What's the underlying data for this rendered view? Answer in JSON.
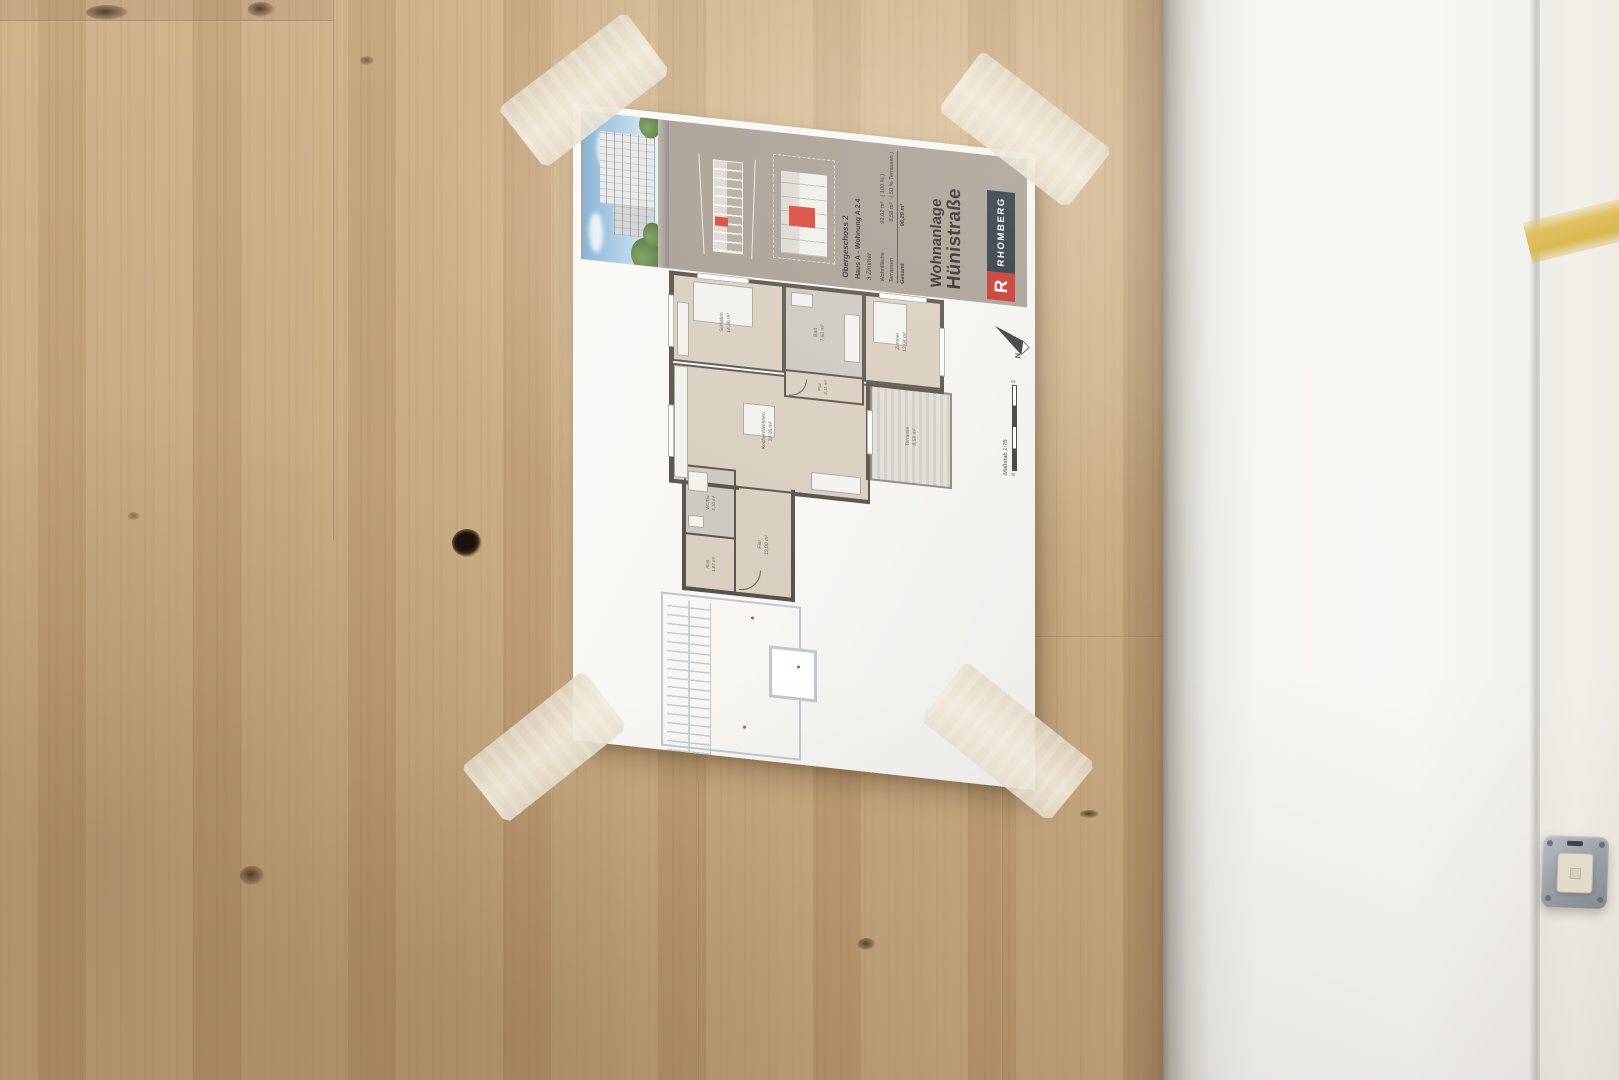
{
  "sheet": {
    "title": {
      "line1": "Wohnanlage",
      "line2": "Hünistraße"
    },
    "brand": {
      "name": "RHOMBERG",
      "initial": "R"
    },
    "unit_info": {
      "floor": "Obergeschoss 2",
      "unit": "Haus A - Wohnung A.2.4",
      "room_count": "3 Zimmer"
    },
    "area_table": {
      "rows": [
        {
          "label": "Wohnfläche",
          "value": "92,02 m²",
          "note": "( 100 % )"
        },
        {
          "label": "Terrassen",
          "value": "8,58 m²",
          "note": "( 50 % Terrassen )"
        },
        {
          "label": "Gesamt",
          "value": "96,29 m²",
          "note": ""
        }
      ]
    },
    "scale": {
      "label": "Maßstab 1:75",
      "zero": "0",
      "five": "5",
      "north": "N"
    },
    "rooms": [
      {
        "name": "Schlafen",
        "area": "14,36 m²"
      },
      {
        "name": "Bad",
        "area": "7,60 m²"
      },
      {
        "name": "Zimmer",
        "area": "12,04 m²"
      },
      {
        "name": "Flur",
        "area": "4,11 m²"
      },
      {
        "name": "Kochen/Wohnen",
        "area": "33,05 m²"
      },
      {
        "name": "Terrasse",
        "area": "8,58 m²"
      },
      {
        "name": "WC/Du",
        "area": "4,10 m²"
      },
      {
        "name": "Abst.",
        "area": "1,87 m²"
      },
      {
        "name": "Flur",
        "area": "13,00 m²"
      }
    ]
  },
  "colors": {
    "wood_base": "#c3a277",
    "paper": "#f8f7f4",
    "sidebar_band": "#a89f95",
    "brand_red": "#c6342c",
    "logo_navy": "#2a3642",
    "unit_highlight_red": "#d8473b",
    "plan_wall": "#57524b",
    "plan_floor": "#d9cfc0",
    "masking_tape": "#e9e1cf",
    "paint_marking_yellow": "#dfc05e",
    "wall_white": "#f6f5f2"
  }
}
